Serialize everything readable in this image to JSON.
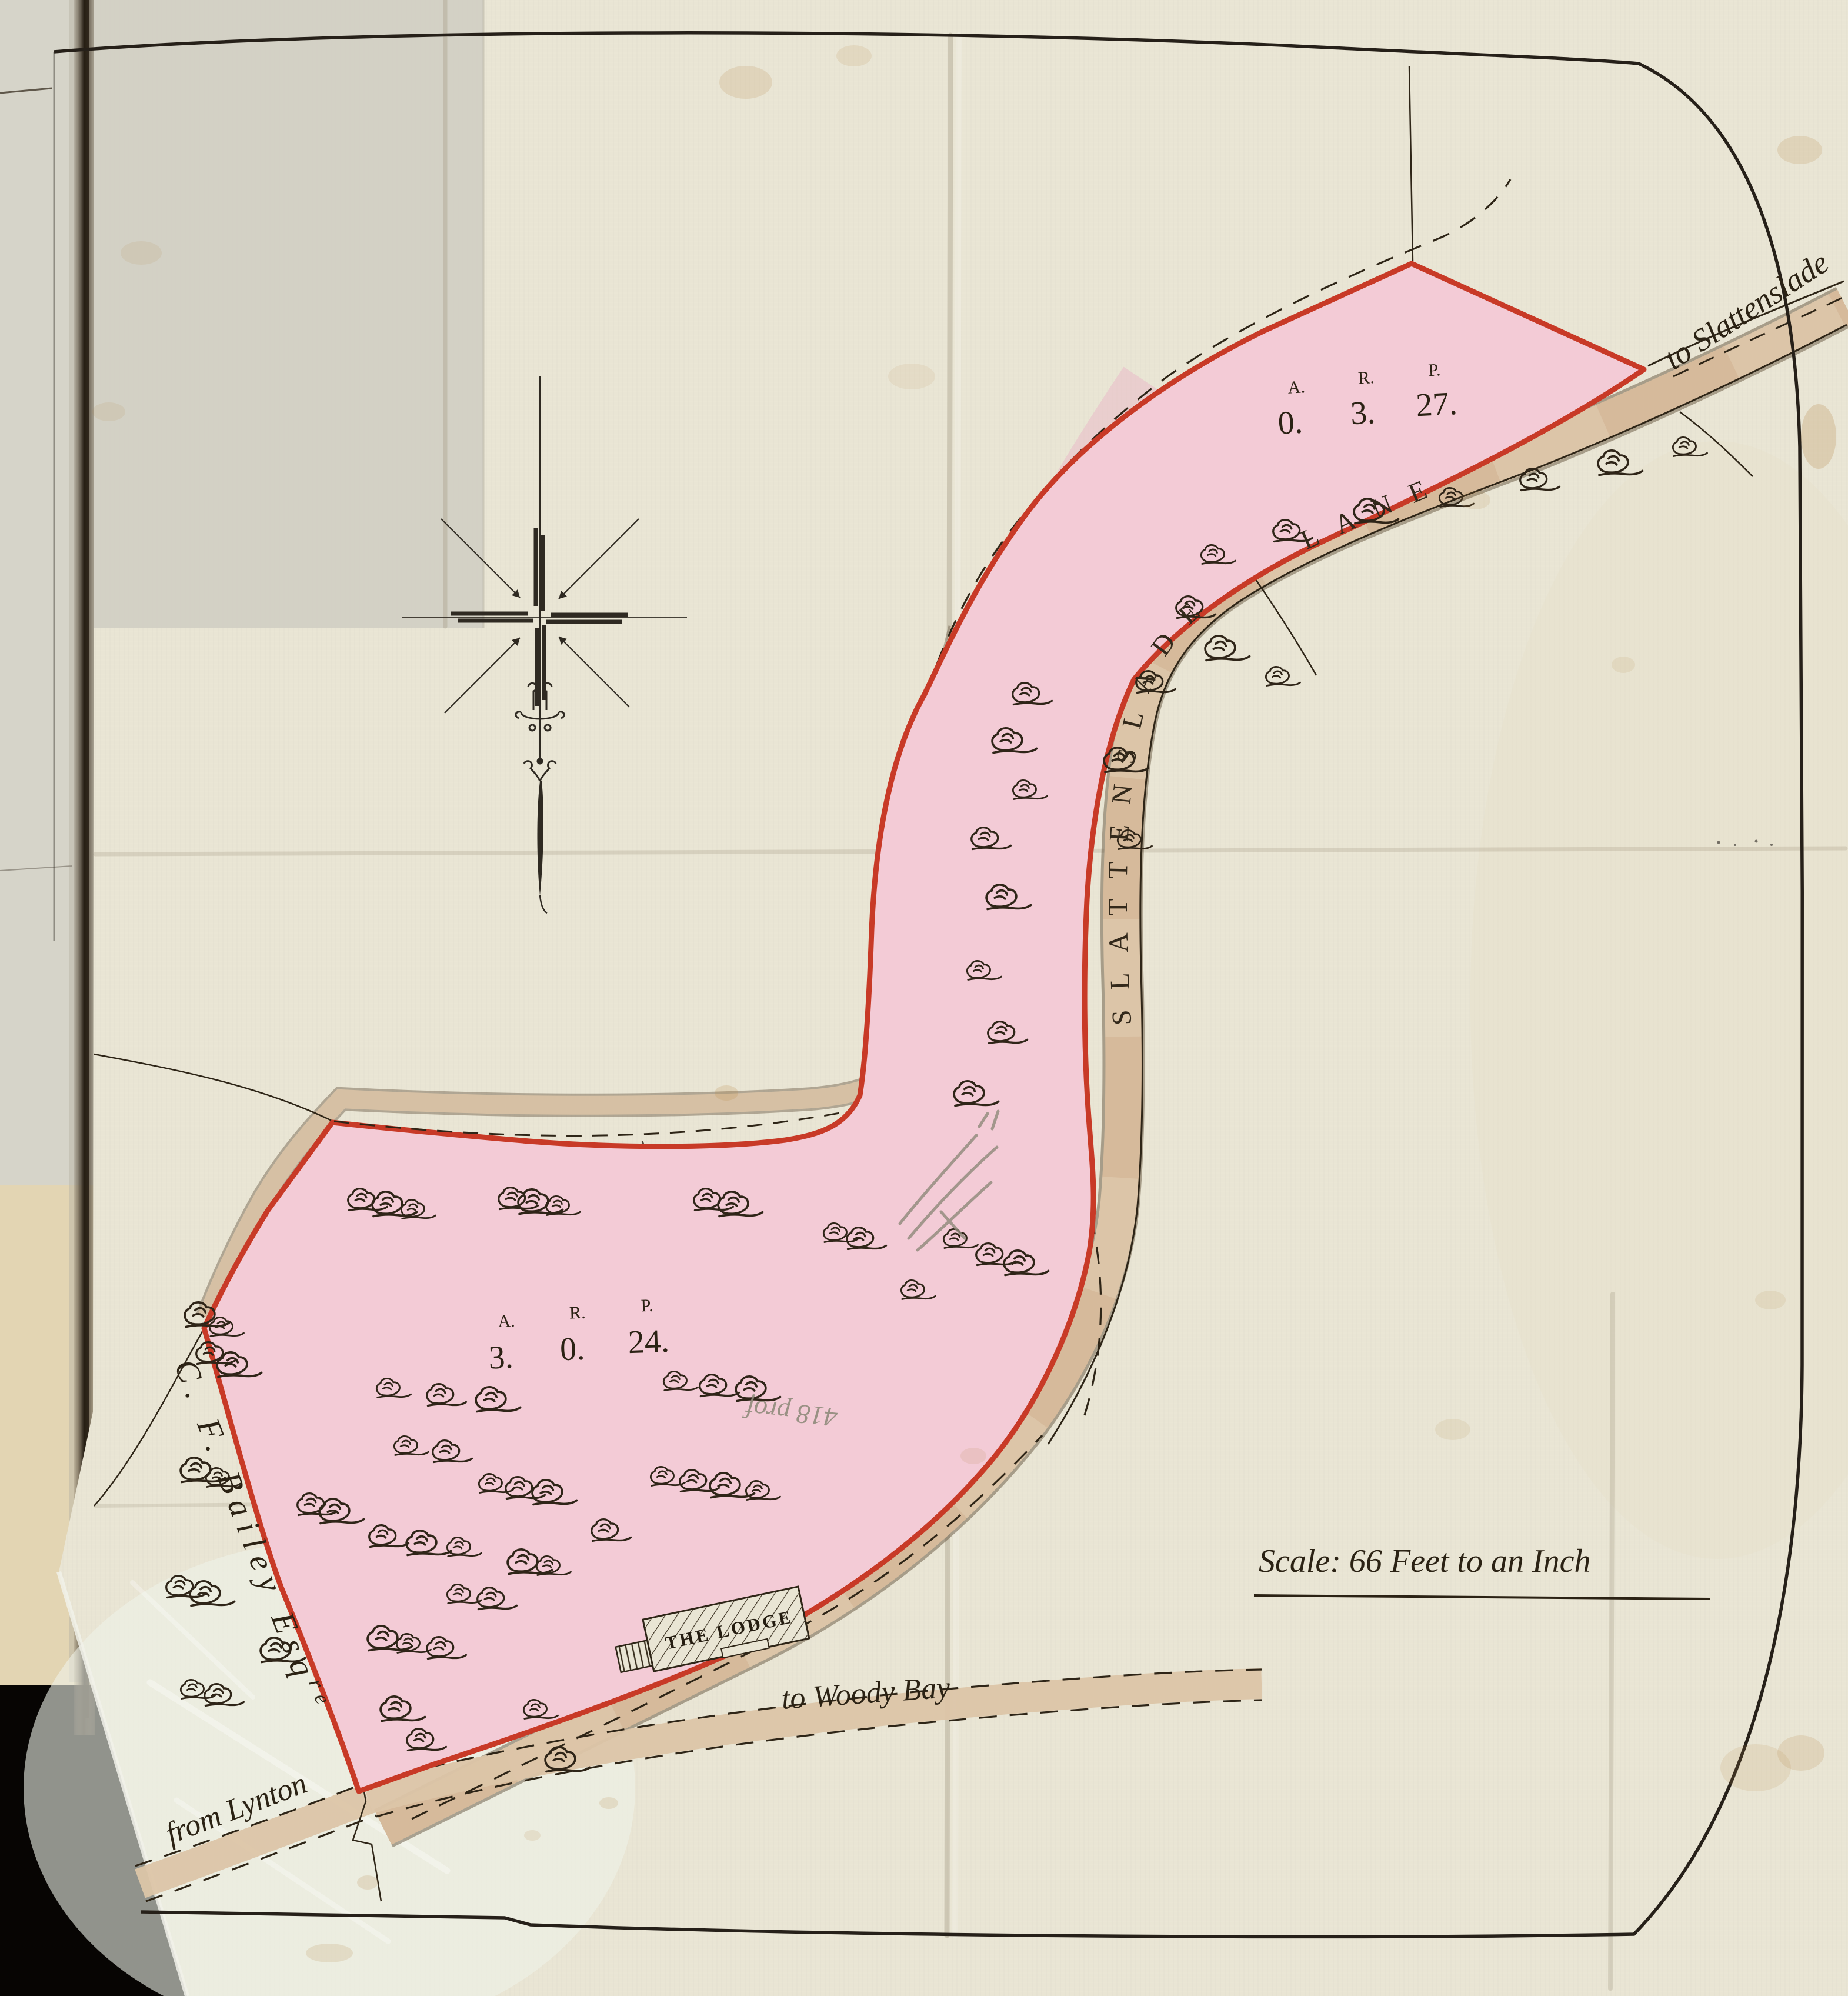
{
  "map": {
    "lane_label": "SLATTENSLADE LANE",
    "to_slattenslade": "to Slattenslade",
    "to_woody_bay": "to Woody Bay",
    "from_lynton": "from Lynton",
    "owner": "C. F. Bailey Esq",
    "owner_suffix": "re",
    "lodge_label": "THE LODGE",
    "scale_label": "Scale:  66 Feet to an Inch",
    "pencil_note": "418 prof",
    "colors": {
      "parcel_pink": "#f3cbd6",
      "boundary_red": "#c83a27",
      "road_tan": "#dcc5a8",
      "ink": "#2e2517",
      "paper": "#e9e5d4"
    },
    "trees": [
      [
        2060,
        945
      ],
      [
        2185,
        905
      ],
      [
        2325,
        872
      ],
      [
        2465,
        848
      ],
      [
        2605,
        818
      ],
      [
        2740,
        790
      ],
      [
        2862,
        762
      ],
      [
        2020,
        1035
      ],
      [
        2072,
        1105
      ],
      [
        2170,
        1152
      ],
      [
        1952,
        1162
      ],
      [
        1900,
        1295
      ],
      [
        1918,
        1430
      ],
      [
        1742,
        1182
      ],
      [
        1710,
        1262
      ],
      [
        1740,
        1345
      ],
      [
        1672,
        1428
      ],
      [
        1700,
        1528
      ],
      [
        1662,
        1652
      ],
      [
        1700,
        1758
      ],
      [
        1645,
        1862
      ],
      [
        1622,
        2108
      ],
      [
        1680,
        2135
      ],
      [
        1730,
        2150
      ],
      [
        1550,
        2195
      ],
      [
        612,
        2042
      ],
      [
        656,
        2050
      ],
      [
        700,
        2058
      ],
      [
        868,
        2040
      ],
      [
        904,
        2046
      ],
      [
        946,
        2052
      ],
      [
        1200,
        2042
      ],
      [
        1244,
        2050
      ],
      [
        1418,
        2098
      ],
      [
        1460,
        2108
      ],
      [
        337,
        2238
      ],
      [
        374,
        2258
      ],
      [
        354,
        2303
      ],
      [
        392,
        2323
      ],
      [
        658,
        2362
      ],
      [
        746,
        2374
      ],
      [
        832,
        2382
      ],
      [
        1146,
        2350
      ],
      [
        1210,
        2358
      ],
      [
        1274,
        2364
      ],
      [
        688,
        2460
      ],
      [
        756,
        2470
      ],
      [
        330,
        2502
      ],
      [
        368,
        2514
      ],
      [
        526,
        2560
      ],
      [
        566,
        2572
      ],
      [
        832,
        2524
      ],
      [
        880,
        2532
      ],
      [
        928,
        2540
      ],
      [
        1124,
        2512
      ],
      [
        1176,
        2520
      ],
      [
        1230,
        2528
      ],
      [
        1286,
        2536
      ],
      [
        648,
        2614
      ],
      [
        714,
        2626
      ],
      [
        778,
        2632
      ],
      [
        1026,
        2604
      ],
      [
        886,
        2658
      ],
      [
        930,
        2664
      ],
      [
        303,
        2700
      ],
      [
        346,
        2712
      ],
      [
        778,
        2712
      ],
      [
        832,
        2720
      ],
      [
        648,
        2788
      ],
      [
        692,
        2796
      ],
      [
        746,
        2804
      ],
      [
        466,
        2808
      ],
      [
        325,
        2874
      ],
      [
        368,
        2884
      ],
      [
        670,
        2908
      ],
      [
        908,
        2908
      ],
      [
        712,
        2960
      ],
      [
        950,
        2994
      ]
    ]
  },
  "parcels": [
    {
      "name": "upper parcel",
      "acreage": {
        "a": "0.",
        "r": "3.",
        "p": "27."
      }
    },
    {
      "name": "lower parcel",
      "acreage": {
        "a": "3.",
        "r": "0.",
        "p": "24."
      }
    }
  ],
  "units": {
    "a": "A.",
    "r": "R.",
    "p": "P."
  }
}
